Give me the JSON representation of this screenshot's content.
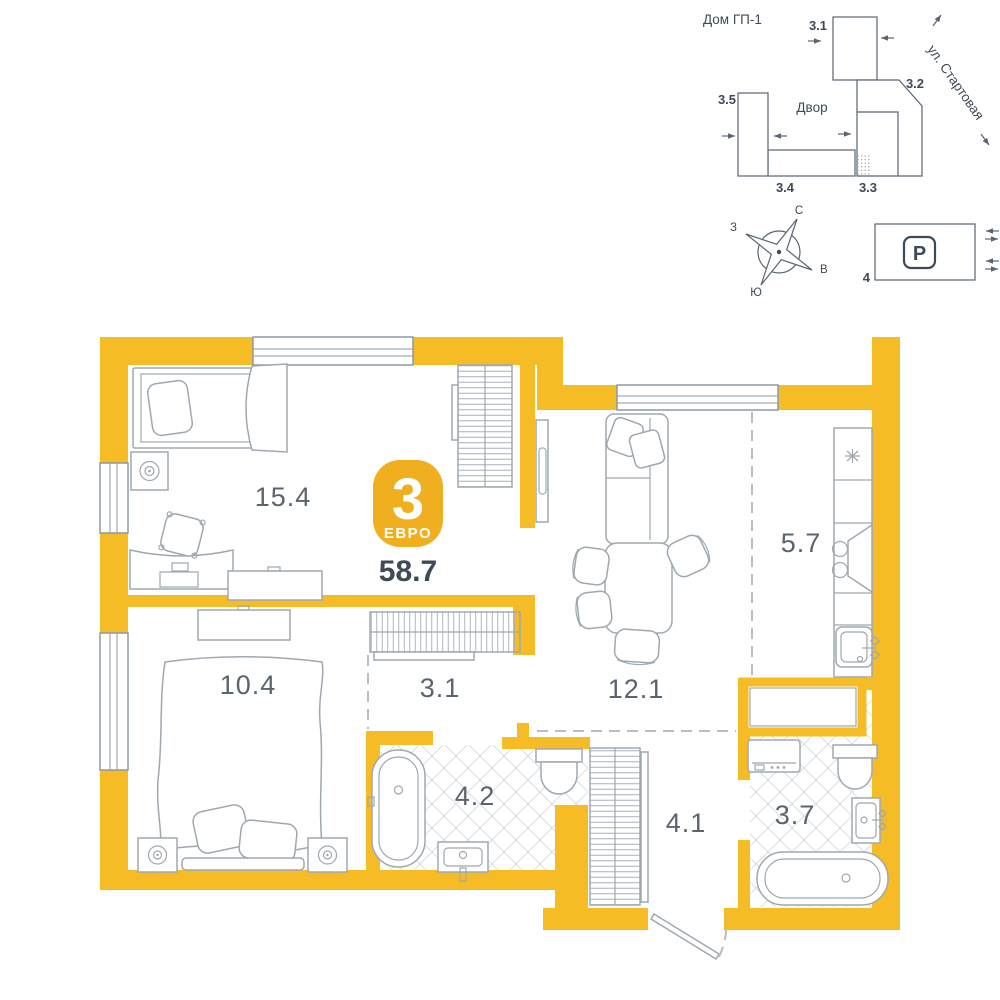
{
  "site_plan": {
    "house_label": "Дом ГП-1",
    "street_label": "ул. Стартовая",
    "courtyard_label": "Двор",
    "buildings": [
      {
        "id": "3.1"
      },
      {
        "id": "3.2"
      },
      {
        "id": "3.3"
      },
      {
        "id": "3.4"
      },
      {
        "id": "3.5"
      }
    ],
    "compass": {
      "north": "С",
      "east": "В",
      "south": "Ю",
      "west": "З"
    },
    "parking": {
      "symbol": "P",
      "number": "4"
    }
  },
  "apartment": {
    "badge": {
      "rooms_count": "3",
      "type_label": "ЕВРО",
      "total_area": "58.7"
    },
    "rooms": [
      {
        "name": "living-room",
        "area": "15.4"
      },
      {
        "name": "bedroom",
        "area": "10.4"
      },
      {
        "name": "hallway",
        "area": "3.1"
      },
      {
        "name": "kitchen-living",
        "area": "12.1"
      },
      {
        "name": "kitchen",
        "area": "5.7"
      },
      {
        "name": "bathroom",
        "area": "4.2"
      },
      {
        "name": "entry-hall",
        "area": "4.1"
      },
      {
        "name": "bathroom-main",
        "area": "3.7"
      }
    ]
  },
  "colors": {
    "wall": "#F5BC25",
    "badge": "#EFAF1E",
    "furniture_line": "#9FA8B1",
    "window_line": "#8E99A5",
    "tile_line": "#DADFE4",
    "dash_line": "#B7BEC6",
    "label_text": "#5A6470",
    "dark_text": "#3F4A58",
    "site_line": "#5A6472"
  }
}
